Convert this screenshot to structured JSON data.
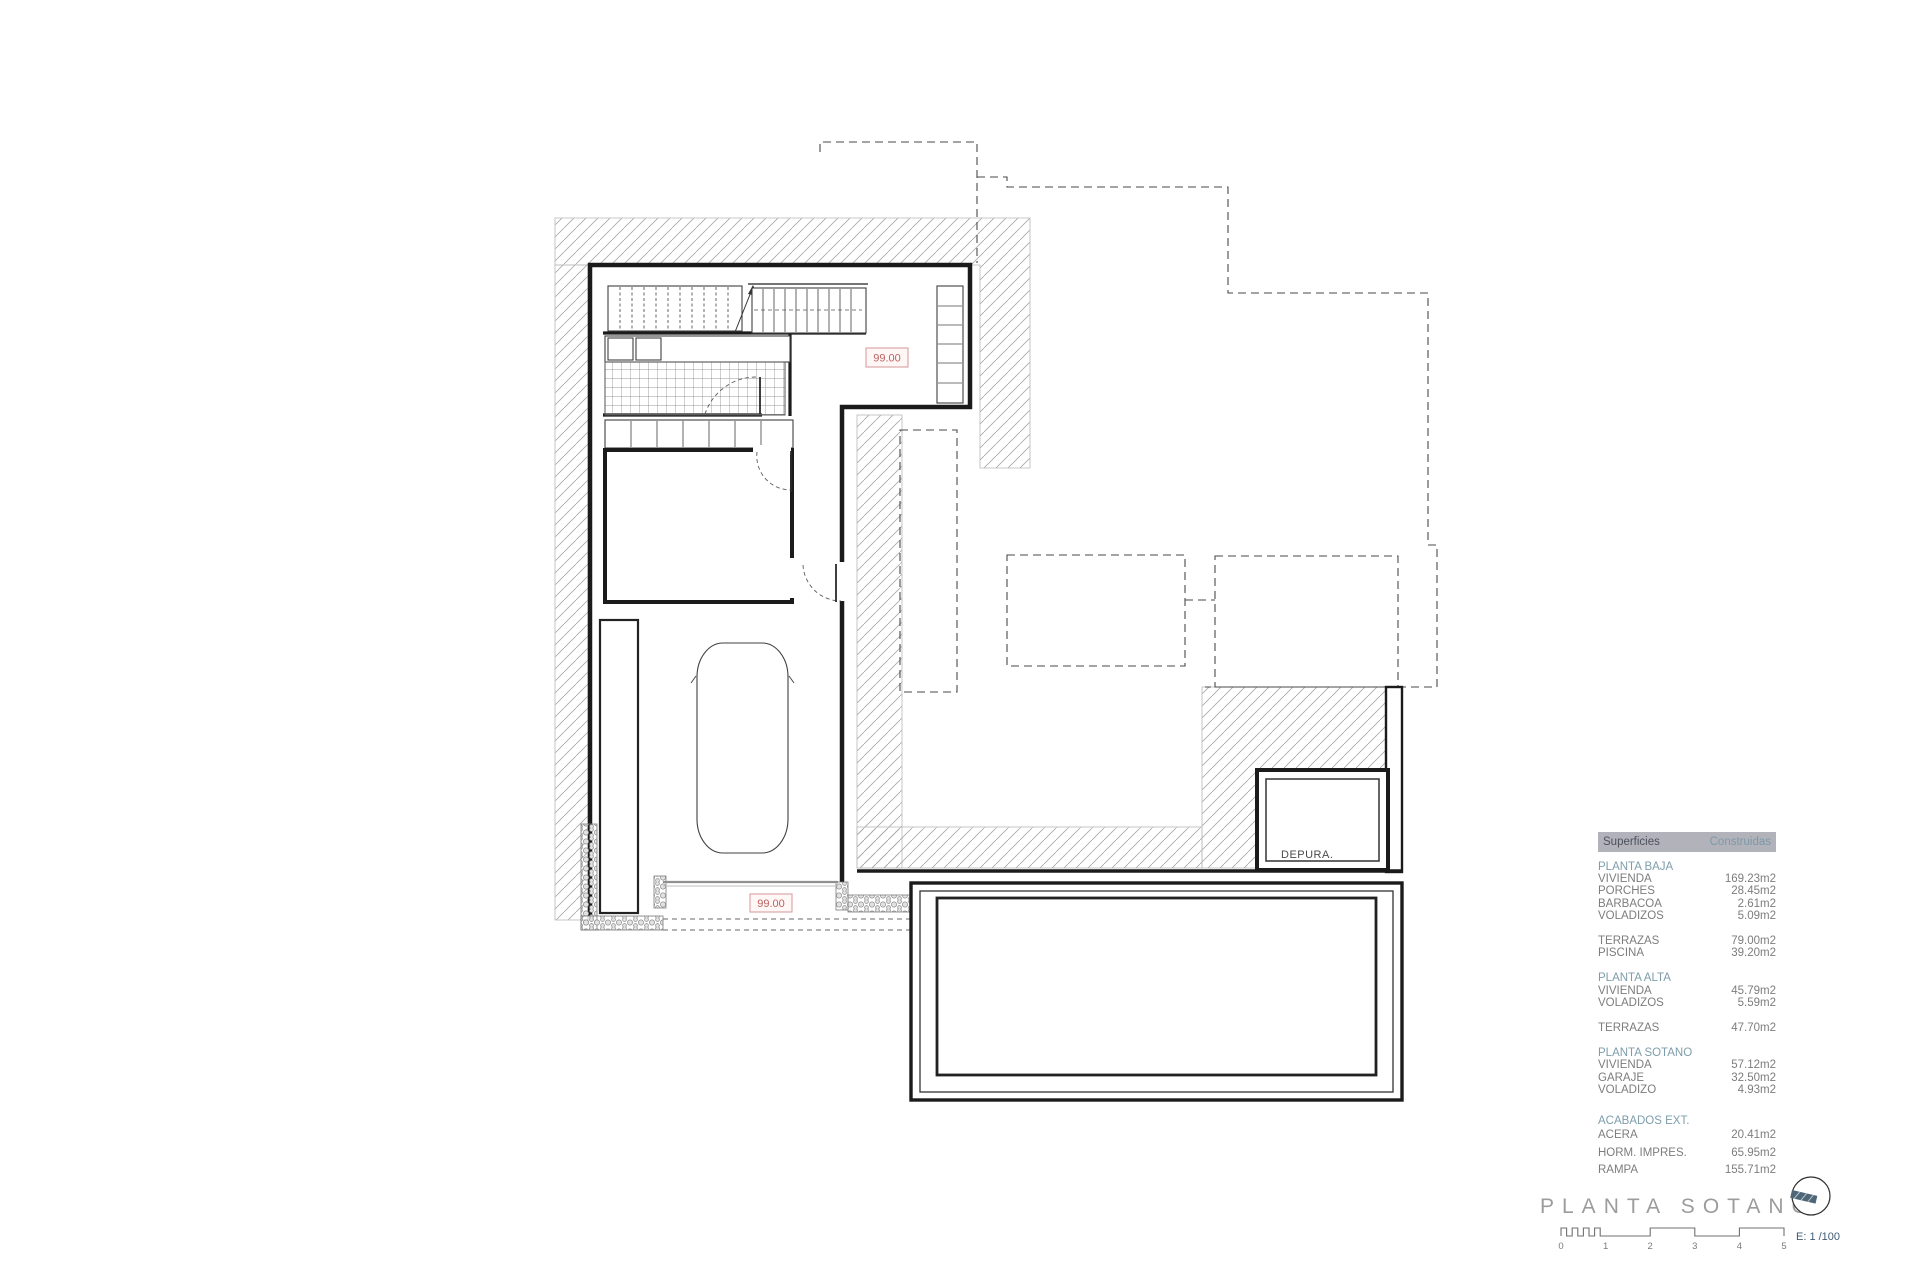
{
  "document": {
    "title_label": "PLANTA SOTANO",
    "scale_label": "E: 1 /100"
  },
  "plan": {
    "room_label": "DEPURA.",
    "level_marks": [
      "99.00",
      "99.00"
    ]
  },
  "scale_bar": {
    "ticks": [
      "0",
      "1",
      "2",
      "3",
      "4",
      "5"
    ]
  },
  "area_table": {
    "header": {
      "col1": "Superficies",
      "col2": "Construidas"
    },
    "rows": [
      {
        "label": "PLANTA BAJA",
        "value": ""
      },
      {
        "label": "VIVIENDA",
        "value": "169.23m2"
      },
      {
        "label": "PORCHES",
        "value": "28.45m2"
      },
      {
        "label": "BARBACOA",
        "value": "2.61m2"
      },
      {
        "label": "VOLADIZOS",
        "value": "5.09m2"
      },
      {
        "label": "TERRAZAS",
        "value": "79.00m2"
      },
      {
        "label": "PISCINA",
        "value": "39.20m2"
      },
      {
        "label": "PLANTA ALTA",
        "value": ""
      },
      {
        "label": "VIVIENDA",
        "value": "45.79m2"
      },
      {
        "label": "VOLADIZOS",
        "value": "5.59m2"
      },
      {
        "label": "TERRAZAS",
        "value": "47.70m2"
      },
      {
        "label": "PLANTA SOTANO",
        "value": ""
      },
      {
        "label": "VIVIENDA",
        "value": "57.12m2"
      },
      {
        "label": "GARAJE",
        "value": "32.50m2"
      },
      {
        "label": "VOLADIZO",
        "value": "4.93m2"
      },
      {
        "label": "ACABADOS EXT.",
        "value": ""
      },
      {
        "label": "ACERA",
        "value": "20.41m2"
      },
      {
        "label": "HORM. IMPRES.",
        "value": "65.95m2"
      },
      {
        "label": "RAMPA",
        "value": "155.71m2"
      }
    ]
  },
  "colors": {
    "section_teal": "#7e9dab",
    "header_bg": "#b2b2ba",
    "level_mark_red": "#bc6060",
    "logo_slate": "#4e6677",
    "scale_text_navy": "#3f5b76"
  }
}
